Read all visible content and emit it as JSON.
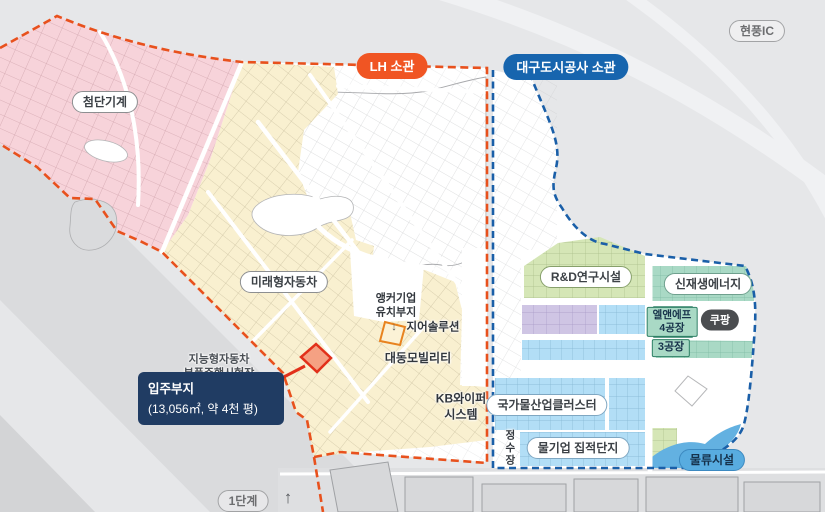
{
  "badges": {
    "highway_exit": "현풍IC",
    "lh": "LH 소관",
    "dcc": "대구도시공사 소관"
  },
  "zones": {
    "advanced_machinery": {
      "label": "첨단기계",
      "color": "#f7d3da"
    },
    "future_auto": {
      "label": "미래형자동차",
      "color": "#f9f0d0"
    },
    "rnd": {
      "label": "R&D연구시설",
      "color": "#d5e6b6"
    },
    "renewable": {
      "label": "신재생에너지",
      "color": "#a9d9c5"
    },
    "water_cluster": {
      "label": "국가물산업클러스터",
      "color": "#b2def6"
    },
    "water_complex": {
      "label": "물기업 집적단지",
      "color": "#b2def6"
    },
    "logistics": {
      "label": "물류시설",
      "color": "#63b1e1"
    },
    "water_plant": {
      "label": "정수장"
    }
  },
  "sites": {
    "anchor": {
      "line1": "앵커기업",
      "line2": "유치부지"
    },
    "gear": "지어솔루션",
    "daedong": "대동모빌리티",
    "kb": {
      "line1": "KB와이퍼",
      "line2": "시스템"
    },
    "proving_ground": {
      "line1": "지능형자동차",
      "line2": "부품주행시험장"
    },
    "lnf": {
      "line1": "엘앤에프",
      "line2": "4공장"
    },
    "coupang": "쿠팡",
    "plant3": "3공장"
  },
  "callout": {
    "line1": "입주부지",
    "line2": "(13,056㎡, 약 4천 평)"
  },
  "stage": {
    "label": "1단계"
  },
  "icons": {
    "up_arrow": "↑",
    "down_arrow": "↓"
  },
  "colors": {
    "lh_boundary": "#e8511d",
    "dcc_boundary": "#1a5fa8",
    "callout_bg": "#203c63",
    "highlight_parcel": "#e2301a"
  }
}
